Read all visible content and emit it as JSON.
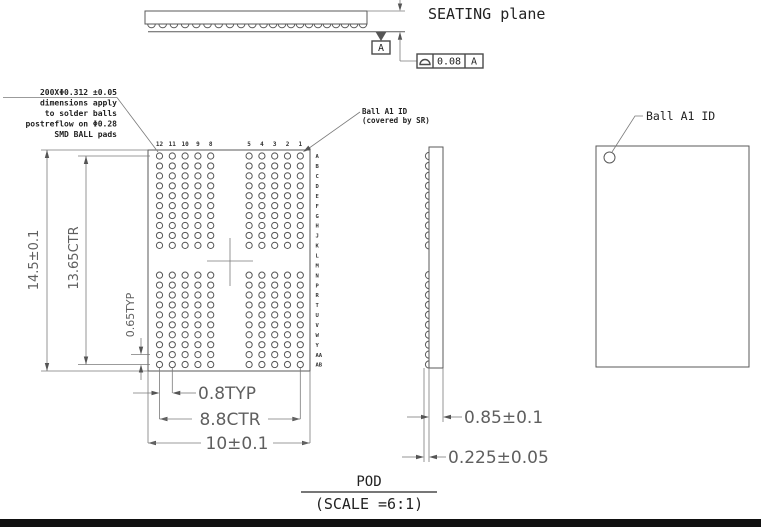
{
  "drawing_notes": {
    "ball_spec": [
      "200XΦ0.312 ±0.05",
      "dimensions apply",
      "to solder balls",
      "postreflow on Φ0.28",
      "SMD BALL pads"
    ],
    "ball_a1_bottom_view": [
      "Ball A1 ID",
      "(covered by SR)"
    ],
    "ball_a1_top_view": "Ball A1 ID",
    "seating_plane": "SEATING plane"
  },
  "datum_flag": "A",
  "fcf": {
    "symbol_name": "flatness-symbol",
    "tolerance": "0.08",
    "datum_ref": "A"
  },
  "dims": {
    "body_length": "14.5±0.1",
    "ball_span_vertical": "13.65CTR",
    "ball_pitch_vertical": "0.65TYP",
    "ball_pitch_horizontal": "0.8TYP",
    "ball_span_horizontal": "8.8CTR",
    "body_width": "10±0.1",
    "body_thickness": "0.85±0.1",
    "ball_height": "0.225±0.05"
  },
  "grid": {
    "col_labels": [
      "12",
      "11",
      "10",
      "9",
      "8",
      "5",
      "4",
      "3",
      "2",
      "1"
    ],
    "row_labels": [
      "A",
      "B",
      "C",
      "D",
      "E",
      "F",
      "G",
      "H",
      "J",
      "K",
      "L",
      "M",
      "N",
      "P",
      "R",
      "T",
      "U",
      "V",
      "W",
      "Y",
      "AA",
      "AB"
    ],
    "rows_without_balls": [
      "L",
      "M"
    ],
    "top_view_ball_groups": [
      11,
      11
    ]
  },
  "title_block": {
    "view_name": "POD",
    "scale": "(SCALE =6:1)"
  }
}
